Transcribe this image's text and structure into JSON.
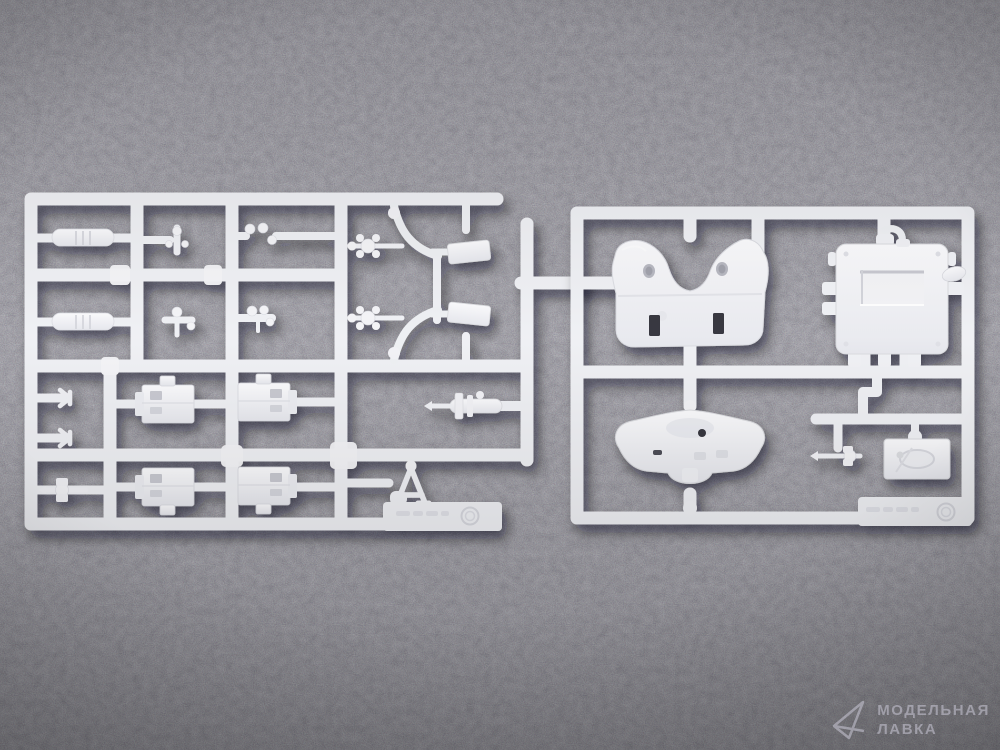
{
  "scene": {
    "type": "product-photo",
    "subject": "Two white injection-molded polystyrene sprues (model-kit part trees) with vehicle parts, lying on dark gray foam",
    "background_color": "#34323c",
    "plastic_color": "#eff0f4",
    "shadow_color": "#07070b"
  },
  "sprues": [
    {
      "name": "left-parts-sprue",
      "parts_note": "mufflers, small fittings, ammo boxes, two machine-gun assemblies, axle, tripod frame",
      "mold_mark": "embossed illegible part number with circled mold logo"
    },
    {
      "name": "right-parts-sprue",
      "parts_note": "saddle-shaped cowl, engine block with recessed window, winged bracket, relief plate, small gun, pipe elbow",
      "mold_mark": "embossed illegible part number with circled mold logo"
    }
  ],
  "watermark": {
    "line1": "МОДЕЛЬНАЯ",
    "line2": "ЛАВКА",
    "logo": "triangle-outline",
    "color": "rgba(199,197,210,0.58)"
  }
}
